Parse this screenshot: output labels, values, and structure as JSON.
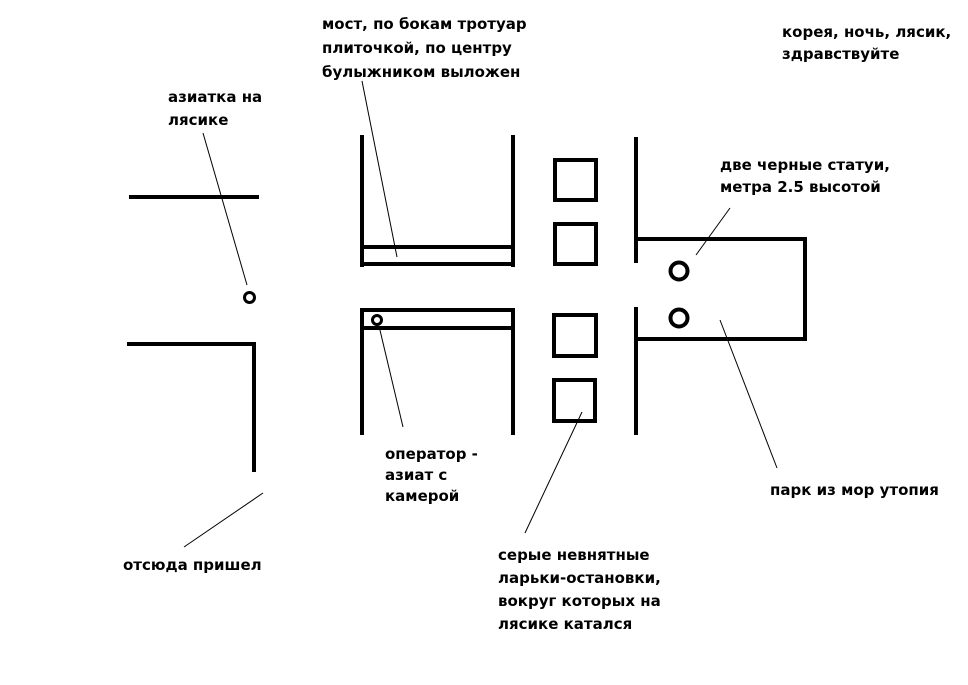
{
  "colors": {
    "ink": "#000000",
    "background": "#ffffff"
  },
  "labels": {
    "bridge": "мост, по бокам тротуар\nплиточкой, по центру\nбулыжником выложен",
    "scene": "корея, ночь, лясик,\nздравствуйте",
    "asian_girl": "азиатка на\nлясике",
    "statues": "две черные статуи,\nметра 2.5 высотой",
    "operator": "оператор -\nазиат с\nкамерой",
    "kiosks": "серые невнятные\nларьки-остановки,\nвокруг которых на\nлясике катался",
    "park": "парк из мор утопия",
    "origin": "отсюда пришел"
  },
  "figures": {
    "asian_girl_marker": "small-ring",
    "operator_marker": "small-ring",
    "statue_marker_1": "ring",
    "statue_marker_2": "ring",
    "kiosk_squares_count": 4
  }
}
